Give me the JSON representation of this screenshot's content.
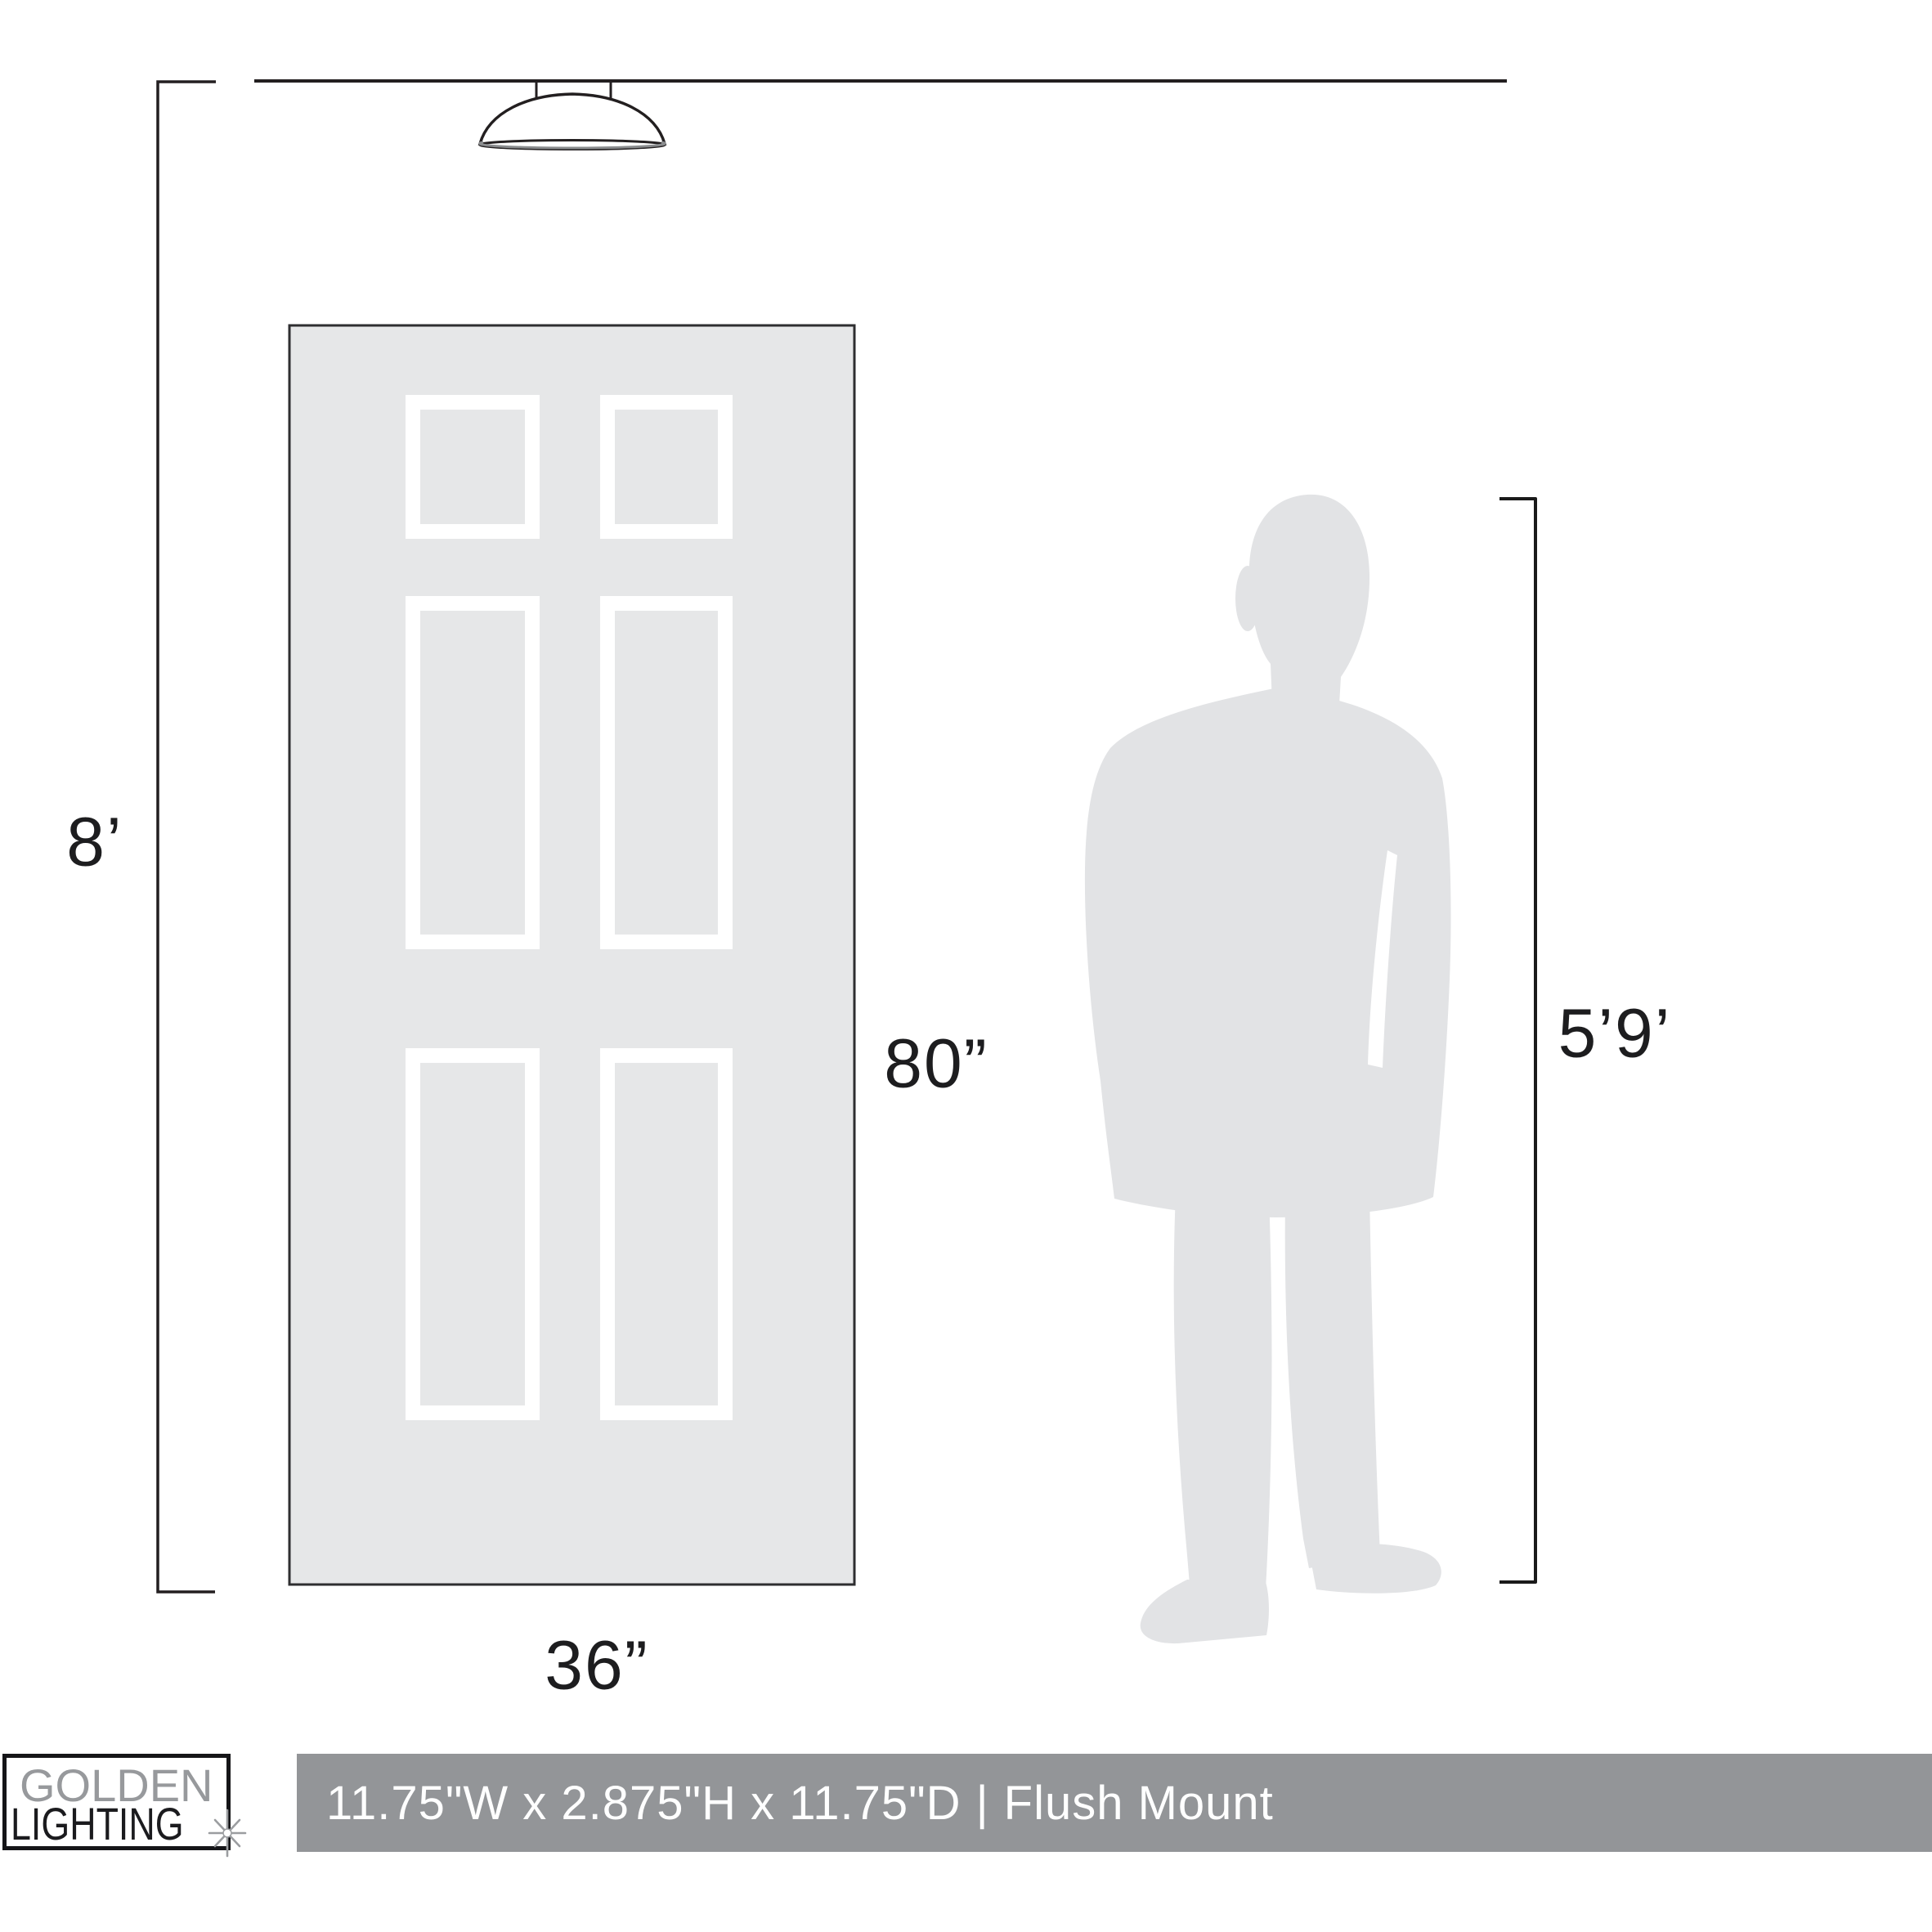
{
  "diagram": {
    "type": "product-scale-diagram",
    "line_color": "#231F20",
    "door_fill": "#E6E7E8",
    "panel_frame_color": "#FFFFFF",
    "silhouette_fill": "#E2E3E5",
    "objects": [
      "ceiling-line",
      "flush-mount-fixture",
      "six-panel-door",
      "man-silhouette"
    ]
  },
  "labels": {
    "ceiling_height": "8’",
    "door_height": "80”",
    "door_width": "36”",
    "person_height": "5’9’"
  },
  "footer": {
    "bar_color": "#939598",
    "text_color": "#FFFFFF",
    "dimensions": "11.75\"W x 2.875\"H x 11.75\"D",
    "separator": "|",
    "mount_type": "Flush Mount"
  },
  "brand": {
    "name_line1": "GOLDEN",
    "name_line2": "LIGHTING",
    "line1_color": "#97999C",
    "line2_color": "#1B1B1E",
    "sparkle_icon": "sparkle-star"
  }
}
